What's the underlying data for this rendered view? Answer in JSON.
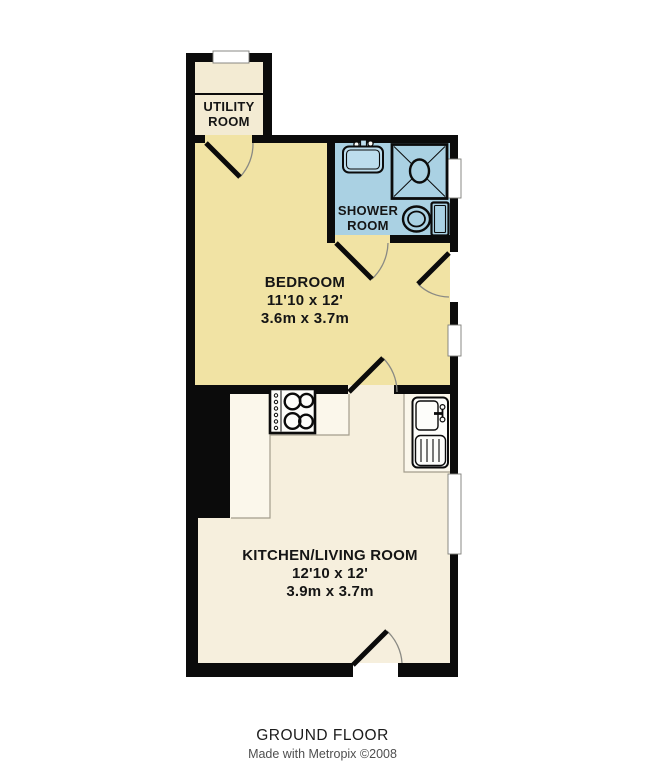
{
  "colors": {
    "wall": "#0b0b0b",
    "bedroom_fill": "#f1e3a4",
    "shower_fill": "#aad1e3",
    "basin_fill": "#bddded",
    "utility_fill": "#f3ebd3",
    "kitchen_fill": "#f6efdd",
    "counter_fill": "#fbf7eb",
    "fixture_fill": "#fdfdfa",
    "window_fill": "#ffffff",
    "window_frame": "#7d7d78",
    "door_arc": "#8a8a84",
    "counter_line": "#a39d8d",
    "label_text": "#151515",
    "credit_text": "#4f4f4f"
  },
  "rooms": {
    "utility": {
      "label_line1": "UTILITY",
      "label_line2": "ROOM"
    },
    "shower": {
      "label_line1": "SHOWER",
      "label_line2": "ROOM"
    },
    "bedroom": {
      "name": "BEDROOM",
      "size_imperial": "11'10 x 12'",
      "size_metric": "3.6m x 3.7m"
    },
    "kitchen_living": {
      "name": "KITCHEN/LIVING ROOM",
      "size_imperial": "12'10 x 12'",
      "size_metric": "3.9m x 3.7m"
    }
  },
  "footer": {
    "floor_label": "GROUND FLOOR",
    "credit": "Made with Metropix ©2008"
  }
}
